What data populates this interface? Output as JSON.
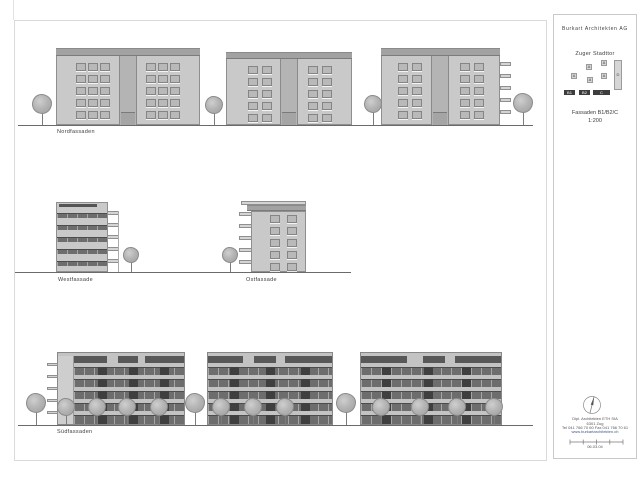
{
  "titleblock": {
    "firm": "Burkart Architekten AG",
    "project": "Zuger Stadttor",
    "sheet_title": "Fassaden B1/B2/C",
    "scale": "1:200",
    "address_line1": "Dipl. Architekten ETH SIA",
    "address_line2": "6301 Zug",
    "address_line3": "Tel 041 766 70 60   Fax 041 766 70 61",
    "website": "www.burkartarchitekten.ch",
    "date": "06.03.04",
    "site_plan": {
      "blocks": [
        {
          "label": "A",
          "x": 32,
          "y": 49,
          "w": 6,
          "h": 6,
          "dark": false
        },
        {
          "label": "A",
          "x": 47,
          "y": 45,
          "w": 6,
          "h": 6,
          "dark": false
        },
        {
          "label": "A",
          "x": 17,
          "y": 58,
          "w": 6,
          "h": 6,
          "dark": false
        },
        {
          "label": "A",
          "x": 33,
          "y": 62,
          "w": 6,
          "h": 6,
          "dark": false
        },
        {
          "label": "A",
          "x": 47,
          "y": 58,
          "w": 6,
          "h": 6,
          "dark": false
        },
        {
          "label": "D",
          "x": 60,
          "y": 45,
          "w": 8,
          "h": 30,
          "dark": false
        },
        {
          "label": "B1",
          "x": 10,
          "y": 75,
          "w": 11,
          "h": 5,
          "dark": true
        },
        {
          "label": "B2",
          "x": 25,
          "y": 75,
          "w": 11,
          "h": 5,
          "dark": true
        },
        {
          "label": "C",
          "x": 39,
          "y": 75,
          "w": 17,
          "h": 5,
          "dark": true
        }
      ]
    }
  },
  "colors": {
    "facade_light": "#c9c9c9",
    "facade_mid": "#a2a2a2",
    "glass_dark": "#6d6d6d",
    "outline": "#8a8a8a",
    "ground_line": "#6a6a6a"
  },
  "drawing": {
    "ground_lines": [
      {
        "x1": 18,
        "y": 125,
        "x2": 533
      },
      {
        "x1": 15,
        "y": 272,
        "x2": 351
      },
      {
        "x1": 18,
        "y": 425,
        "x2": 533
      }
    ],
    "row_labels": [
      {
        "text": "Nordfassaden",
        "x": 57,
        "y": 129
      },
      {
        "text": "Westfassade",
        "x": 58,
        "y": 277
      },
      {
        "text": "Ostfassade",
        "x": 246,
        "y": 277
      },
      {
        "text": "Südfassaden",
        "x": 57,
        "y": 429
      }
    ],
    "north_buildings": [
      {
        "x": 56,
        "top": 48,
        "w": 144,
        "ground": 125,
        "roof_h": 8,
        "core": {
          "x": 119,
          "w": 18,
          "door_y": 112
        },
        "grids": [
          76,
          146
        ],
        "cols": 3,
        "win": {
          "w": 10,
          "h": 8,
          "pitch": 12
        },
        "rows_y": [
          63,
          75,
          87,
          99,
          111
        ]
      },
      {
        "x": 226,
        "top": 52,
        "w": 126,
        "ground": 125,
        "roof_h": 7,
        "core": {
          "x": 280,
          "w": 18,
          "door_y": 112
        },
        "grids": [
          248,
          308
        ],
        "cols": 2,
        "win": {
          "w": 10,
          "h": 8,
          "pitch": 14
        },
        "rows_y": [
          66,
          78,
          90,
          102,
          114
        ]
      },
      {
        "x": 381,
        "top": 48,
        "w": 119,
        "ground": 125,
        "roof_h": 8,
        "core": {
          "x": 431,
          "w": 18,
          "door_y": 112
        },
        "grids": [
          398,
          460
        ],
        "cols": 2,
        "win": {
          "w": 10,
          "h": 8,
          "pitch": 14
        },
        "rows_y": [
          63,
          75,
          87,
          99,
          111
        ],
        "balconies": {
          "x": 500,
          "w": 11,
          "h": 4,
          "ys": [
            62,
            74,
            86,
            98,
            110
          ]
        }
      }
    ],
    "west_building": {
      "x": 56,
      "top": 202,
      "w": 52,
      "ground": 272,
      "bands_y": [
        213,
        225,
        237,
        249,
        261
      ],
      "band_h": 5,
      "slabs": {
        "x": 107,
        "w": 12,
        "h": 4,
        "ys": [
          211,
          223,
          235,
          247,
          259
        ]
      },
      "edge_line_x": 118
    },
    "east_building": {
      "ledge": {
        "x": 241,
        "y": 201,
        "w": 65,
        "h": 4
      },
      "roof": {
        "x": 247,
        "y": 205,
        "w": 59,
        "h": 6
      },
      "body": {
        "x": 251,
        "y": 211,
        "w": 55,
        "ground": 272
      },
      "win": {
        "cols_x": [
          270,
          287
        ],
        "rows_y": [
          215,
          227,
          239,
          251,
          263
        ],
        "w": 10,
        "h": 8
      },
      "slabs": {
        "x": 239,
        "w": 13,
        "h": 4,
        "ys": [
          212,
          224,
          236,
          248,
          260
        ]
      }
    },
    "south_spec": {
      "attic_off": 4,
      "attic_h": 7,
      "bands_off": [
        15,
        27,
        39,
        51
      ],
      "band_h": 8,
      "ground_off": 63
    },
    "south_buildings": [
      {
        "x": 57,
        "w": 128,
        "top": 352,
        "ground": 425,
        "inset_left": 16,
        "slabs": {
          "w": 11,
          "h": 3,
          "ys_off": [
            11,
            23,
            35,
            47,
            59
          ]
        },
        "doors": [
          0.22,
          0.5,
          0.78
        ],
        "attic_gaps": [
          [
            0.3,
            0.1
          ],
          [
            0.58,
            0.07
          ]
        ]
      },
      {
        "x": 207,
        "w": 126,
        "top": 352,
        "ground": 425,
        "inset_left": 0,
        "doors": [
          0.18,
          0.47,
          0.75
        ],
        "attic_gaps": [
          [
            0.28,
            0.09
          ],
          [
            0.55,
            0.07
          ]
        ]
      },
      {
        "x": 360,
        "w": 142,
        "top": 352,
        "ground": 425,
        "inset_left": 0,
        "doors": [
          0.15,
          0.45,
          0.72
        ],
        "attic_gaps": [
          [
            0.33,
            0.11
          ],
          [
            0.6,
            0.07
          ]
        ]
      }
    ],
    "trees": [
      {
        "x": 42,
        "cy": 104,
        "r": 10,
        "ground": 125
      },
      {
        "x": 214,
        "cy": 105,
        "r": 9,
        "ground": 125
      },
      {
        "x": 373,
        "cy": 104,
        "r": 9,
        "ground": 125
      },
      {
        "x": 523,
        "cy": 103,
        "r": 10,
        "ground": 125
      },
      {
        "x": 131,
        "cy": 255,
        "r": 8,
        "ground": 272
      },
      {
        "x": 230,
        "cy": 255,
        "r": 8,
        "ground": 272
      },
      {
        "x": 36,
        "cy": 403,
        "r": 10,
        "ground": 425
      },
      {
        "x": 195,
        "cy": 403,
        "r": 10,
        "ground": 425
      },
      {
        "x": 346,
        "cy": 403,
        "r": 10,
        "ground": 425
      },
      {
        "x": 66,
        "cy": 407,
        "r": 9,
        "ground": 425
      },
      {
        "x": 97,
        "cy": 407,
        "r": 9,
        "ground": 425
      },
      {
        "x": 127,
        "cy": 407,
        "r": 9,
        "ground": 425
      },
      {
        "x": 159,
        "cy": 407,
        "r": 9,
        "ground": 425
      },
      {
        "x": 221,
        "cy": 407,
        "r": 9,
        "ground": 425
      },
      {
        "x": 253,
        "cy": 407,
        "r": 9,
        "ground": 425
      },
      {
        "x": 285,
        "cy": 407,
        "r": 9,
        "ground": 425
      },
      {
        "x": 381,
        "cy": 407,
        "r": 9,
        "ground": 425
      },
      {
        "x": 420,
        "cy": 407,
        "r": 9,
        "ground": 425
      },
      {
        "x": 457,
        "cy": 407,
        "r": 9,
        "ground": 425
      },
      {
        "x": 494,
        "cy": 407,
        "r": 9,
        "ground": 425
      }
    ]
  }
}
